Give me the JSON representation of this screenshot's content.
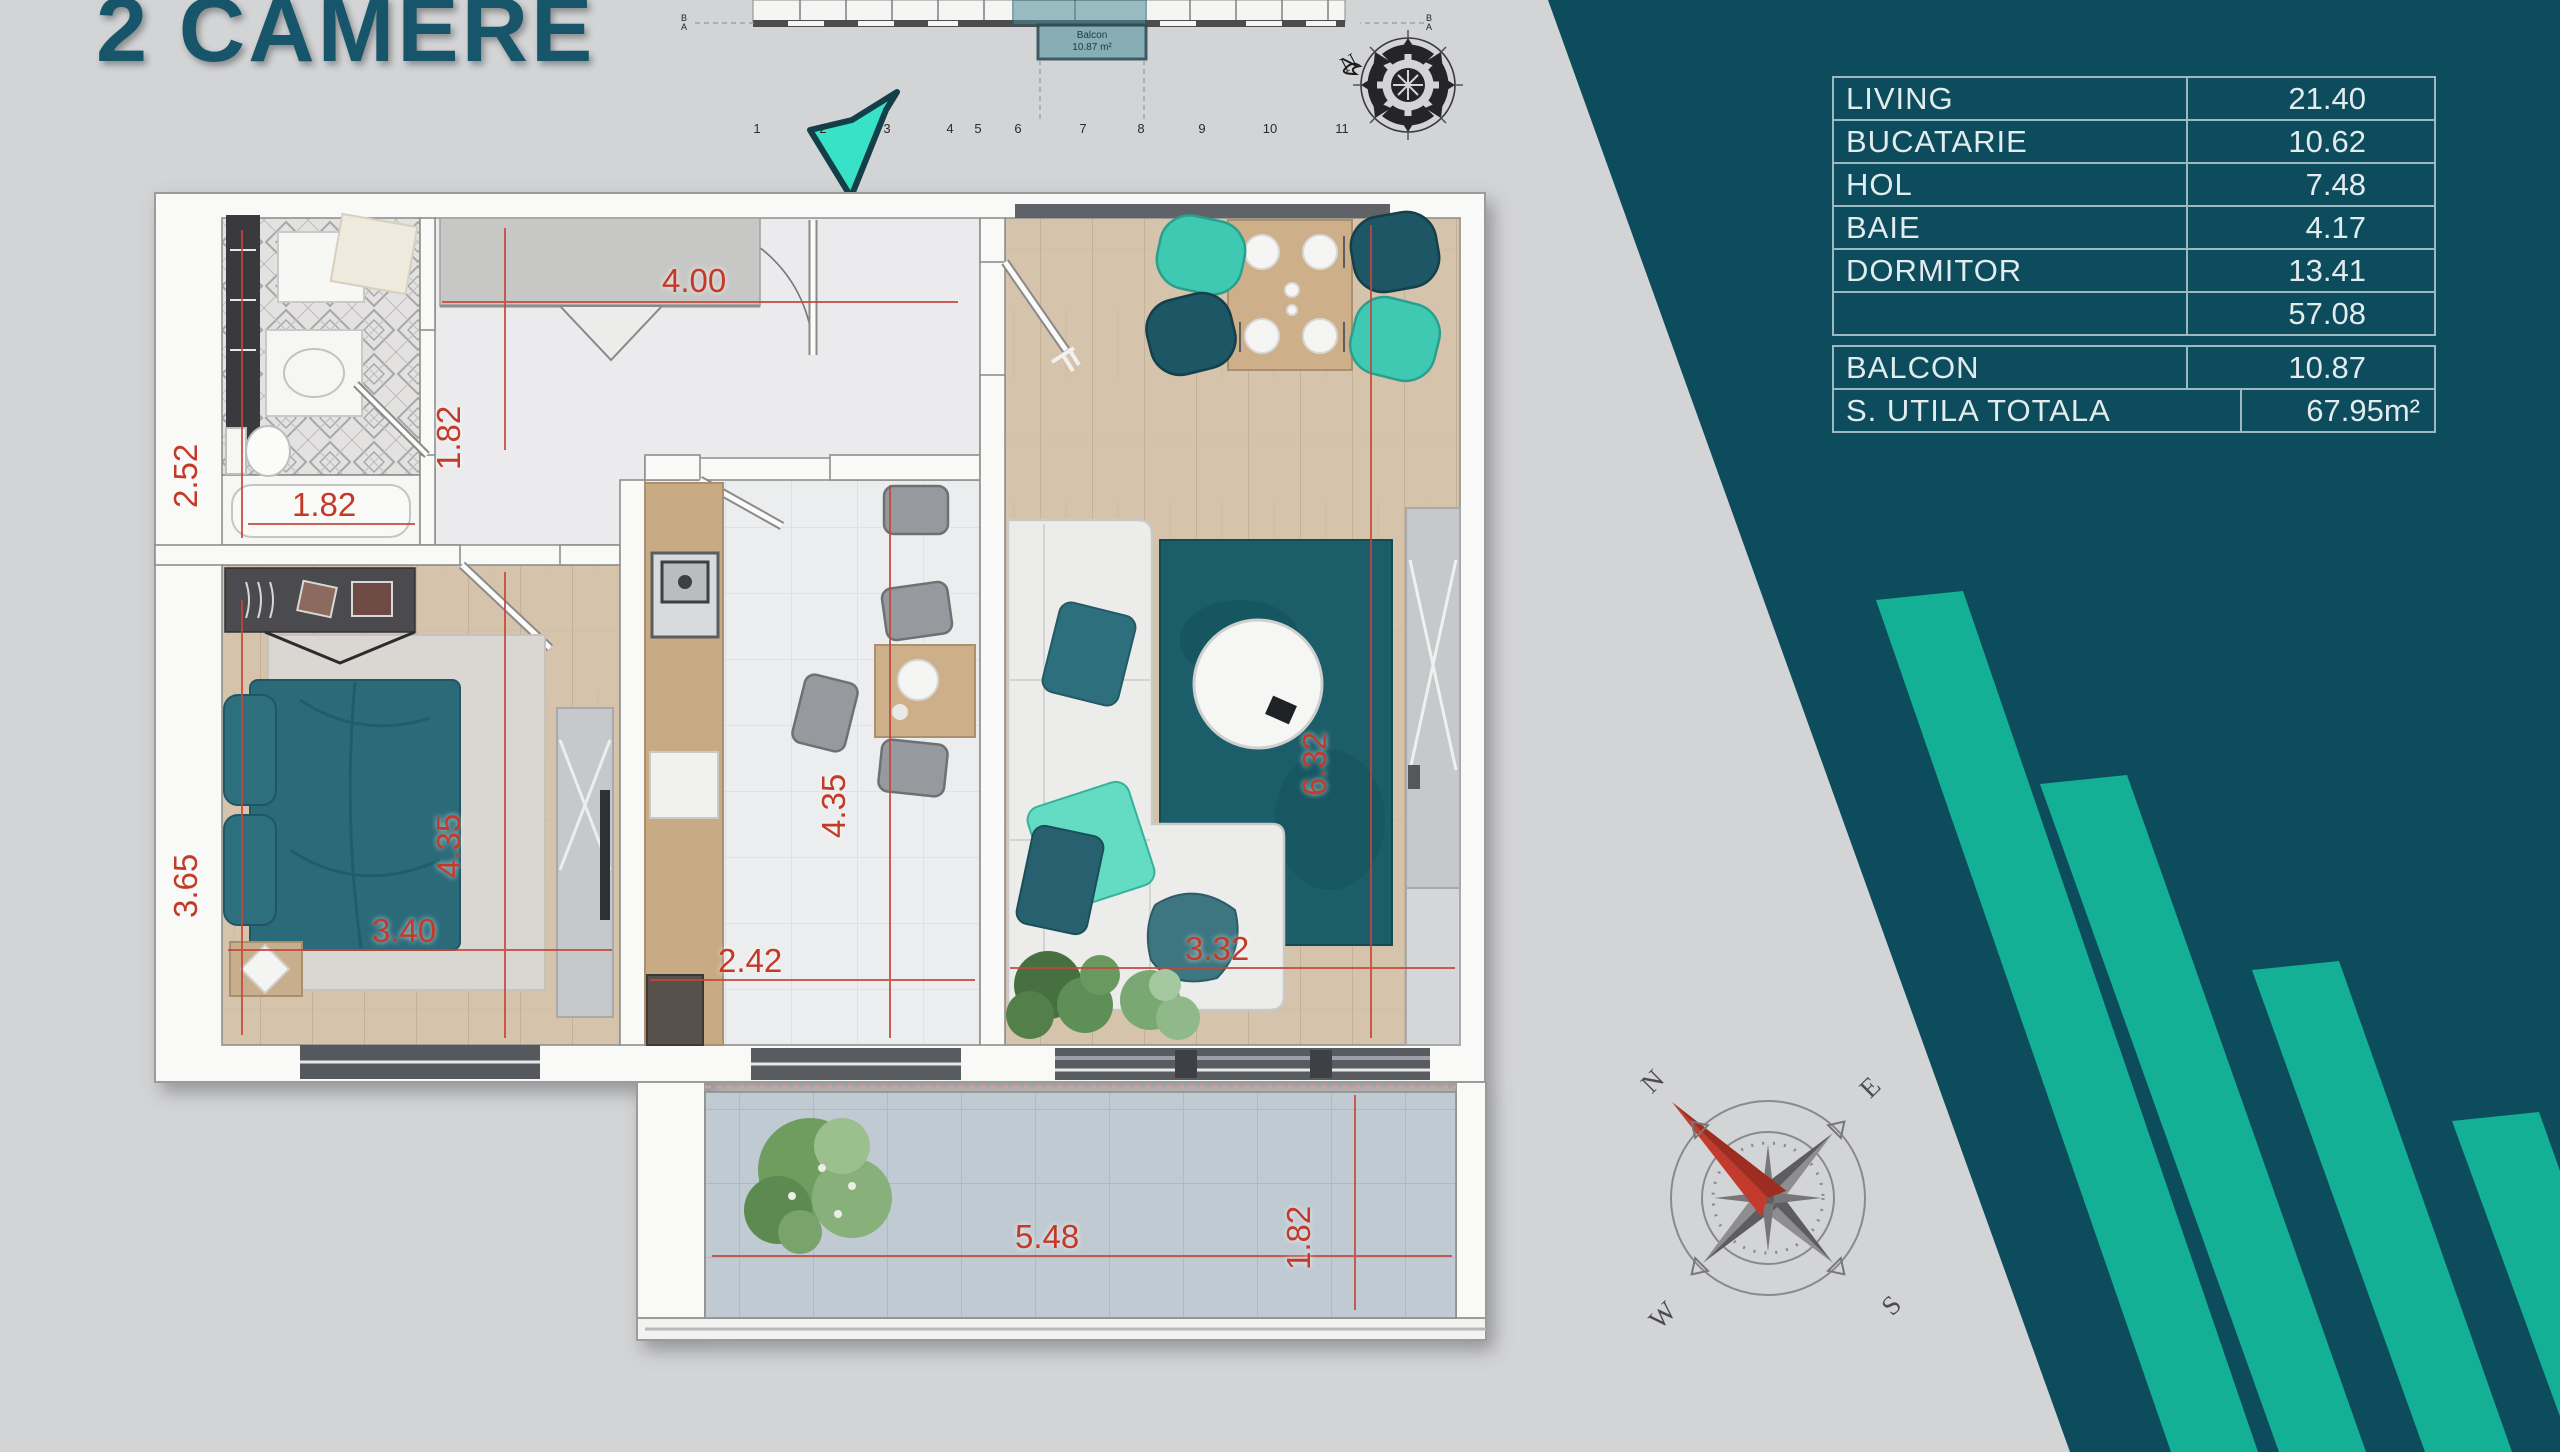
{
  "title": "2 CAMERE",
  "colors": {
    "background_gray": "#d3d4d6",
    "teal_dark": "#0d4c5c",
    "stripe_green": "#14b095",
    "dimension_red": "#c43a28",
    "title_teal": "#17566a",
    "table_text": "#e2ecee"
  },
  "area_table": {
    "rows": [
      {
        "label": "LIVING",
        "value": "21.40"
      },
      {
        "label": "BUCATARIE",
        "value": "10.62"
      },
      {
        "label": "HOL",
        "value": "7.48"
      },
      {
        "label": "BAIE",
        "value": "4.17"
      },
      {
        "label": "DORMITOR",
        "value": "13.41"
      },
      {
        "label": "",
        "value": "57.08"
      },
      {
        "label": "BALCON",
        "value": "10.87"
      },
      {
        "label": "S. UTILA TOTALA",
        "value": "67.95m²"
      }
    ]
  },
  "dims": [
    "4.00",
    "1.82",
    "2.52",
    "1.82",
    "3.65",
    "4.35",
    "4.35",
    "3.40",
    "2.42",
    "3.32",
    "6.32",
    "1.82",
    "5.48"
  ],
  "overview": {
    "grid_numbers": [
      "1",
      "2",
      "3",
      "4",
      "5",
      "6",
      "7",
      "8",
      "9",
      "10",
      "11"
    ],
    "axis_left": {
      "top": "B",
      "bottom": "A"
    },
    "axis_right": {
      "top": "B",
      "bottom": "A"
    },
    "balcony_label": {
      "line1": "Balcon",
      "line2": "10.87 m²"
    }
  },
  "compass": {
    "n": "N",
    "e": "E",
    "s": "S",
    "w": "W",
    "top_n": "N"
  }
}
